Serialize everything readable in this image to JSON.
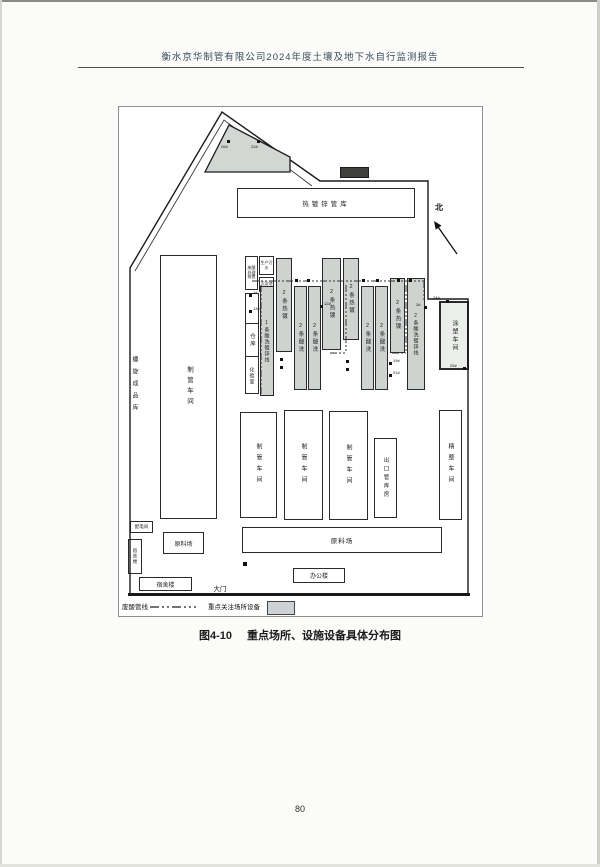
{
  "page": {
    "header": "衡水京华制管有限公司2024年度土壤及地下水自行监测报告",
    "caption_figure": "图4-10",
    "caption_title": "重点场所、设施设备具体分布图",
    "page_number": "80"
  },
  "diagram": {
    "north": "北",
    "gate": "大门",
    "legend": {
      "pipeline": "废酸管线",
      "highlight": "重点关注场所设备"
    },
    "buildings": {
      "spray": "喷漆车间",
      "galv_warehouse": "热镀锌管库",
      "spiral_store": "螺旋成品库",
      "pipe_workshop_main": "制管车间",
      "acid_treatment": "废酸处理装置",
      "sewage": "生产污水",
      "sediment": "沉淀池",
      "warehouse": "仓库",
      "lab": "化验室",
      "coating": "涂塑车间",
      "pipe_workshop_1": "制管车间",
      "pipe_workshop_2": "制管车间",
      "pipe_workshop_3": "制管车间",
      "export_store": "出口管库房",
      "finishing": "精整车间",
      "material_yard_small": "原料场",
      "power_room": "配电间",
      "dorm_small": "宿舍楼",
      "dorm_large": "宿舍楼",
      "material_yard_long": "原料场",
      "office": "办公楼"
    },
    "lines": [
      "1条酸洗镀锌线",
      "2条热镀",
      "2条酸洗",
      "2条酸洗",
      "2条热镀",
      "2条热镀",
      "2条酸洗",
      "2条酸洗",
      "2条热镀",
      "2条酸洗镀锌线"
    ],
    "points": {
      "p1": "1#",
      "p13": "13#",
      "p12": "12#",
      "p2": "2#",
      "p19": "19#",
      "p21": "21#",
      "p24": "24#",
      "p25": "25#",
      "p26": "26#",
      "p22": "22#"
    },
    "colors": {
      "highlight_fill": "#ced3d0",
      "boundary": "#1a1a1a"
    }
  }
}
